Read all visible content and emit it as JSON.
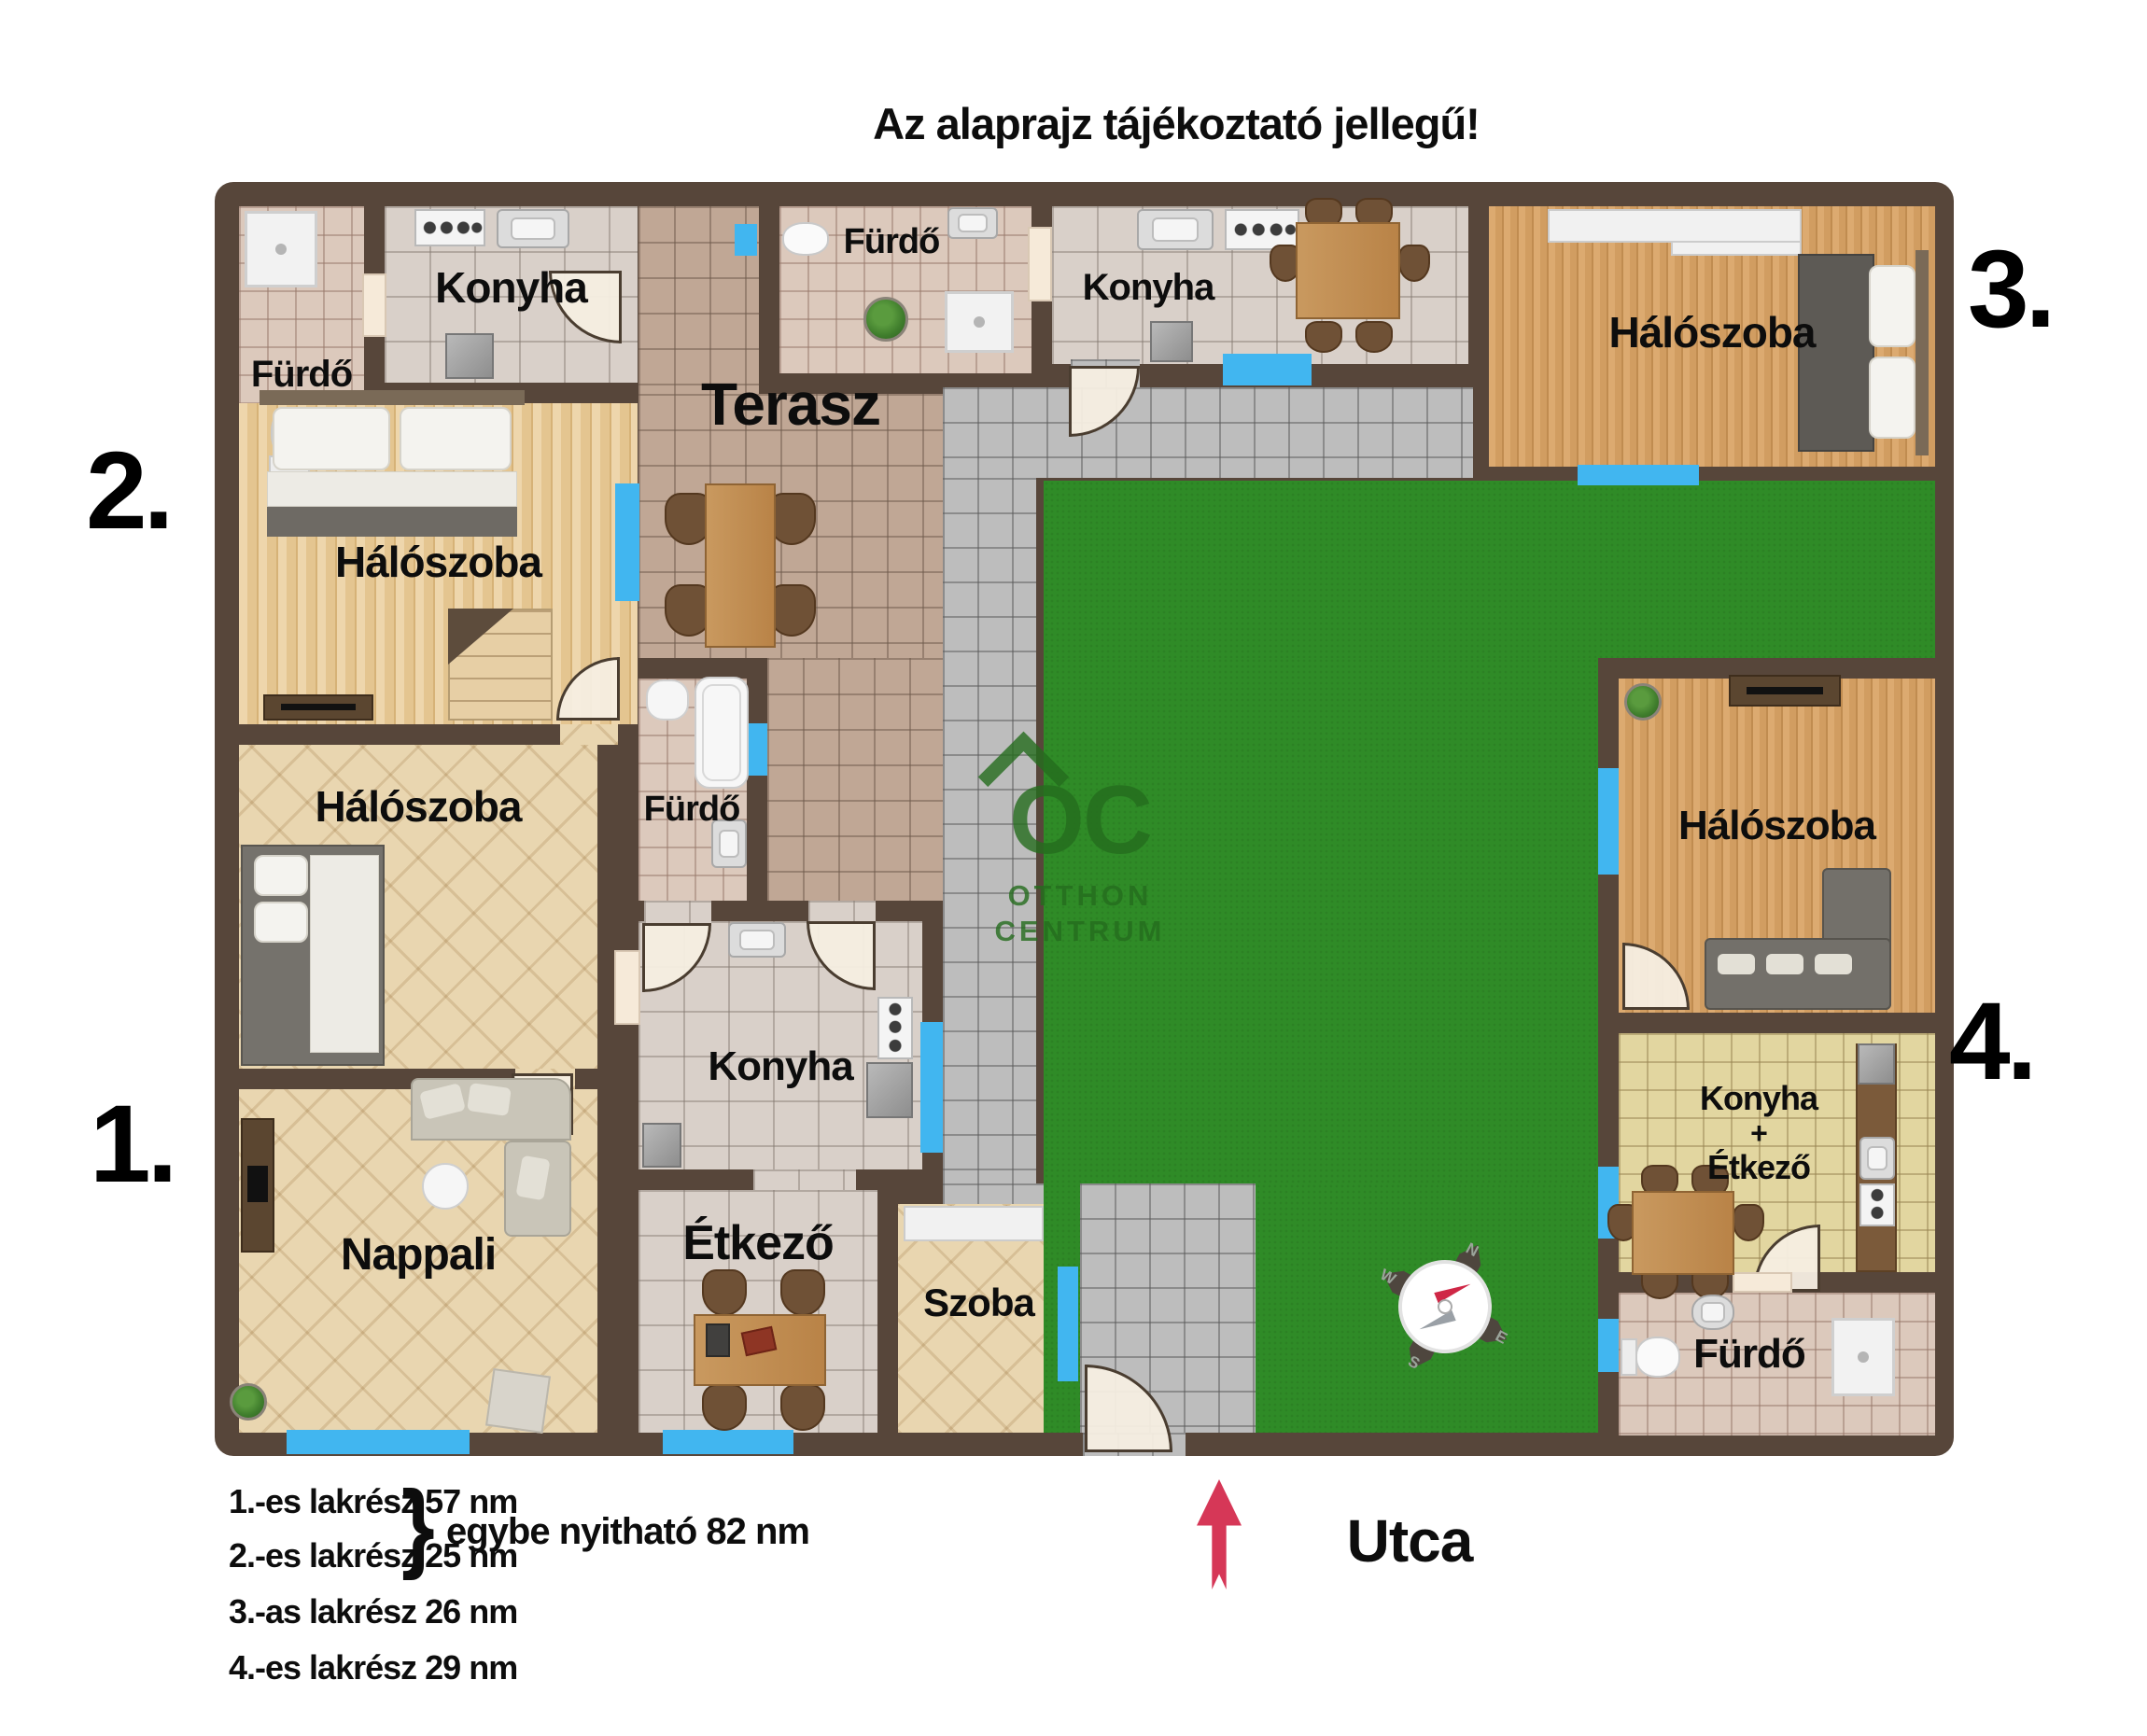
{
  "title": "Az alaprajz tájékoztató jellegű!",
  "street_label": "Utca",
  "unit_numbers": {
    "u1": "1.",
    "u2": "2.",
    "u3": "3.",
    "u4": "4."
  },
  "rooms": {
    "u2_furdo": "Fürdő",
    "u2_konyha": "Konyha",
    "u2_halo": "Hálószoba",
    "u1_halo": "Hálószoba",
    "nappali": "Nappali",
    "terasz": "Terasz",
    "furdo_top": "Fürdő",
    "furdo_mid": "Fürdő",
    "u1_konyha": "Konyha",
    "etkezo": "Étkező",
    "szoba": "Szoba",
    "u3_konyha": "Konyha",
    "u3_halo": "Hálószoba",
    "u4_halo": "Hálószoba",
    "u4_konyha_l1": "Konyha",
    "u4_konyha_l2": "+",
    "u4_konyha_l3": "Étkező",
    "u4_furdo": "Fürdő"
  },
  "legend": {
    "items": [
      "1.-es lakrész 57 nm",
      "2.-es lakrész 25 nm",
      "3.-as lakrész 26 nm",
      "4.-es lakrész 29 nm"
    ],
    "brace": "}",
    "combined": "egybe nyitható 82 nm"
  },
  "compass": {
    "n": "N",
    "w": "W",
    "s": "S",
    "e": "E"
  },
  "watermark": {
    "logo": "OC",
    "line1": "OTTHON",
    "line2": "CENTRUM"
  },
  "colors": {
    "wall": "#57463a",
    "grass": "#2f8b27",
    "window": "#41b6f0",
    "arrow": "#d63757",
    "watermark": "#256d1e"
  }
}
